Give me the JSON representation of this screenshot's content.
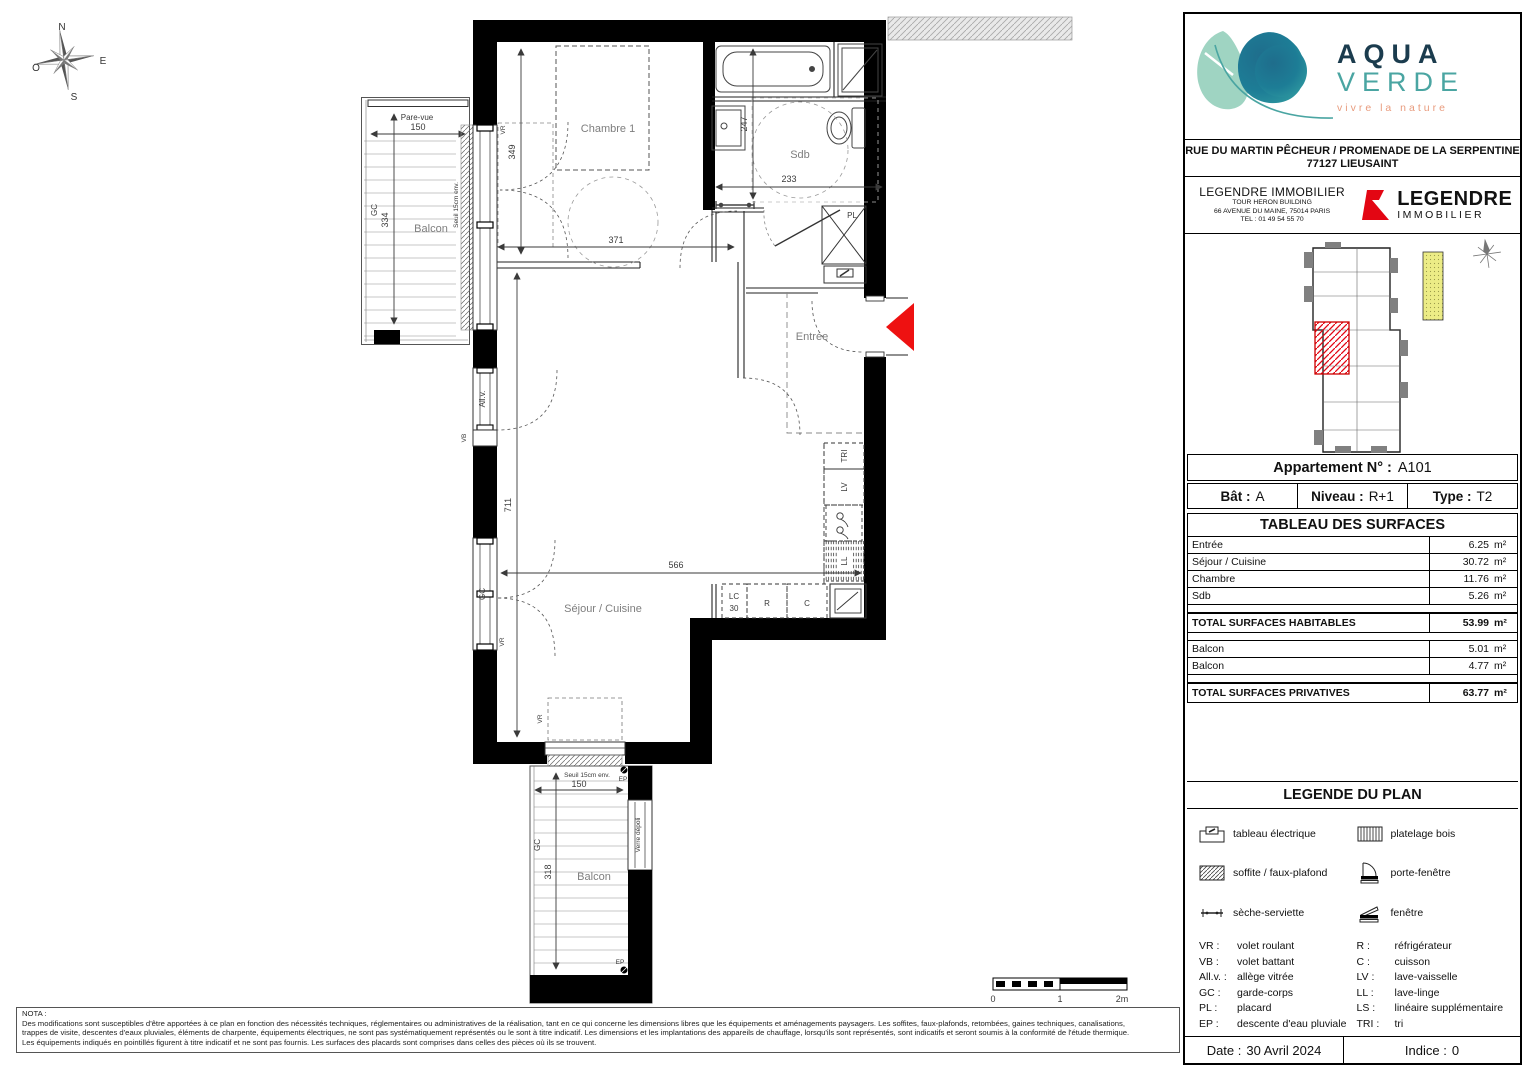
{
  "colors": {
    "aqua_navy": "#1b3c4e",
    "aqua_teal": "#4aa5a2",
    "aqua_mint": "#9fd4c2",
    "aqua_blob": "#1f6d8c",
    "tagline_salmon": "#e89b7d",
    "legendre_red": "#e30613",
    "arrow_red": "#ee1111",
    "keyplan_yellow": "#ecec86"
  },
  "compass": {
    "n": "N",
    "e": "E",
    "s": "S",
    "o": "O"
  },
  "plan": {
    "rooms": {
      "chambre": "Chambre 1",
      "sdb": "Sdb",
      "entree": "Entrée",
      "sejour": "Séjour / Cuisine",
      "balcon_top": "Balcon",
      "balcon_bottom": "Balcon"
    },
    "dims": {
      "top150": "150",
      "v334": "334",
      "v349": "349",
      "h371": "371",
      "v247": "247",
      "h233": "233",
      "v711": "711",
      "h566": "566",
      "bottom150": "150",
      "v318": "318"
    },
    "ann": {
      "pare_vue": "Pare-vue",
      "gc_top": "GC",
      "seuil_top": "Seuil 15cm env.",
      "vr_window": "VR",
      "allv": "All.v.",
      "vb": "VB",
      "gc_left": "GC",
      "vr_left": "VR",
      "pl": "PL",
      "tri": "TRI",
      "lv": "LV",
      "ll": "LL",
      "lc": "LC",
      "lc30": "30",
      "r": "R",
      "c": "C",
      "vr_bottom": "VR",
      "seuil_bottom": "Seuil 15cm env.",
      "ep_top": "EP",
      "ep_bottom": "EP",
      "gc_bottom": "GC",
      "verre_depoli": "Verre dépoli"
    },
    "scale": {
      "s0": "0",
      "s1": "1",
      "s2": "2m"
    }
  },
  "nota": {
    "title": "NOTA :",
    "lines": [
      "Des modifications sont susceptibles d'être apportées à ce plan en fonction des nécessités techniques, réglementaires ou administratives de la réalisation, tant en ce qui concerne les dimensions libres que les équipements et aménagements paysagers. Les soffites, faux-plafonds, retombées, gaines techniques, canalisations,",
      "trappes de visite, descentes d'eaux pluviales, éléments de charpente, équipements électriques, ne sont pas systématiquement représentés ou le sont à titre indicatif. Les dimensions et les implantations des appareils de chauffage, lorsqu'ils sont représentés, sont indicatifs et seront soumis à la conformité de l'étude thermique.",
      "Les équipements indiqués en pointillés figurent à titre indicatif et ne sont pas fournis. Les surfaces des placards sont comprises dans celles des pièces où ils se trouvent."
    ]
  },
  "panel": {
    "brand": {
      "line1": "AQUA",
      "line2": "VERDE",
      "tagline": "vivre la nature"
    },
    "address_line1": "RUE DU MARTIN PÊCHEUR / PROMENADE DE LA SERPENTINE",
    "address_line2": "77127 LIEUSAINT",
    "company": {
      "name": "LEGENDRE IMMOBILIER",
      "line1": "TOUR HERON BUILDING",
      "line2": "66 AVENUE DU MAINE, 75014 PARIS",
      "line3": "TEL : 01 49 54 55 70",
      "logo_name": "LEGENDRE",
      "logo_sub": "IMMOBILIER"
    },
    "apartment": {
      "title_label": "Appartement N° :",
      "title_value": "A101",
      "bat_label": "Bât :",
      "bat_value": "A",
      "niveau_label": "Niveau :",
      "niveau_value": "R+1",
      "type_label": "Type :",
      "type_value": "T2"
    },
    "surfaces": {
      "title": "TABLEAU DES SURFACES",
      "rows": [
        {
          "label": "Entrée",
          "value": "6.25",
          "unit": "m²"
        },
        {
          "label": "Séjour / Cuisine",
          "value": "30.72",
          "unit": "m²"
        },
        {
          "label": "Chambre",
          "value": "11.76",
          "unit": "m²"
        },
        {
          "label": "Sdb",
          "value": "5.26",
          "unit": "m²"
        }
      ],
      "total_habitables": {
        "label": "TOTAL SURFACES HABITABLES",
        "value": "53.99",
        "unit": "m²"
      },
      "balcons": [
        {
          "label": "Balcon",
          "value": "5.01",
          "unit": "m²"
        },
        {
          "label": "Balcon",
          "value": "4.77",
          "unit": "m²"
        }
      ],
      "total_privatives": {
        "label": "TOTAL SURFACES PRIVATIVES",
        "value": "63.77",
        "unit": "m²"
      }
    },
    "legend": {
      "title": "LEGENDE DU PLAN",
      "icons": [
        {
          "icon": "tableau-electrique-icon",
          "label": "tableau électrique"
        },
        {
          "icon": "platelage-bois-icon",
          "label": "platelage bois"
        },
        {
          "icon": "soffite-icon",
          "label": "soffite / faux-plafond"
        },
        {
          "icon": "porte-fenetre-icon",
          "label": "porte-fenêtre"
        },
        {
          "icon": "seche-serviette-icon",
          "label": "sèche-serviette"
        },
        {
          "icon": "fenetre-icon",
          "label": "fenêtre"
        }
      ],
      "abbr_left": [
        {
          "k": "VR :",
          "v": "volet roulant"
        },
        {
          "k": "VB :",
          "v": "volet battant"
        },
        {
          "k": "All.v. :",
          "v": "allège vitrée"
        },
        {
          "k": "GC :",
          "v": "garde-corps"
        },
        {
          "k": "PL :",
          "v": "placard"
        },
        {
          "k": "EP :",
          "v": "descente d'eau pluviale"
        }
      ],
      "abbr_right": [
        {
          "k": "R :",
          "v": "réfrigérateur"
        },
        {
          "k": "C :",
          "v": "cuisson"
        },
        {
          "k": "LV :",
          "v": "lave-vaisselle"
        },
        {
          "k": "LL :",
          "v": "lave-linge"
        },
        {
          "k": "LS :",
          "v": "linéaire supplémentaire"
        },
        {
          "k": "TRI :",
          "v": "tri"
        }
      ]
    },
    "footer": {
      "date_label": "Date :",
      "date_value": "30 Avril 2024",
      "indice_label": "Indice :",
      "indice_value": "0"
    }
  }
}
